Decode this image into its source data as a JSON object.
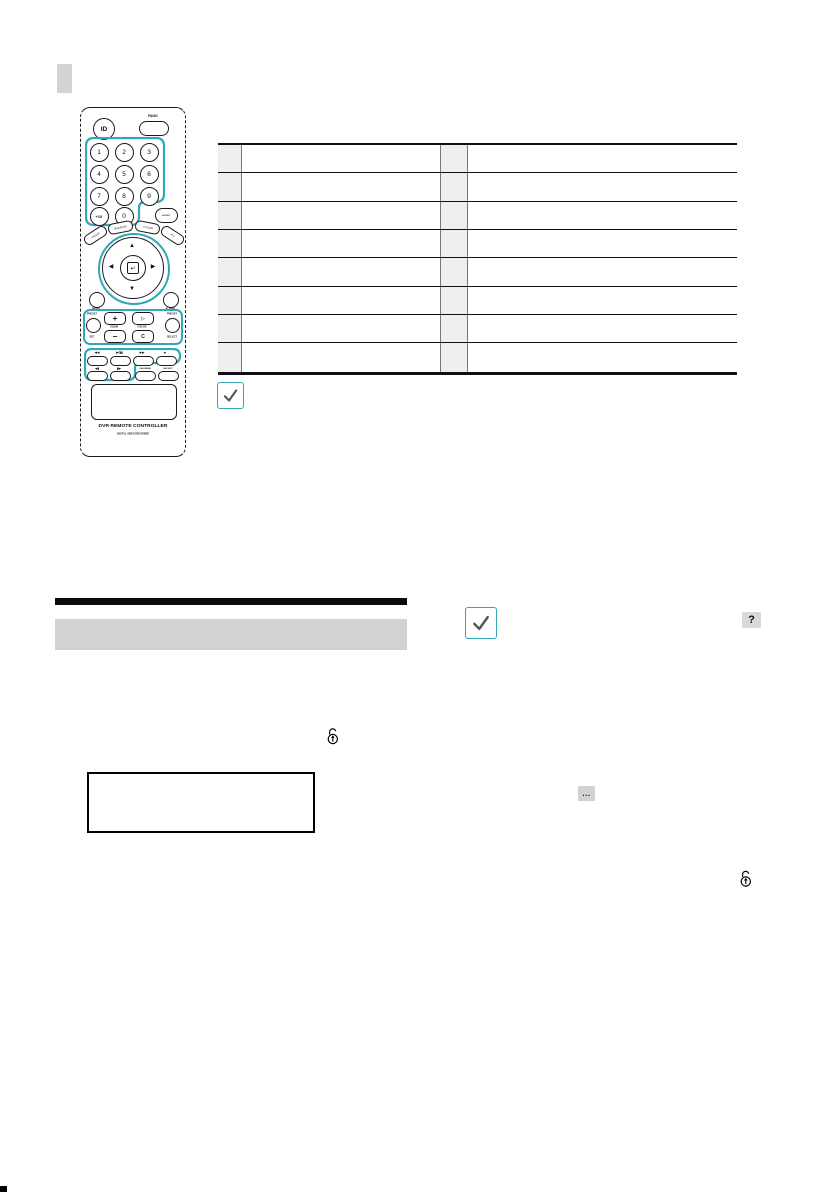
{
  "remote": {
    "id_button": "ID",
    "panic_label": "PANIC",
    "digits": [
      "1",
      "2",
      "3",
      "4",
      "5",
      "6",
      "7",
      "8",
      "9"
    ],
    "plus_ten": "+10",
    "zero": "0",
    "layout_label": "LAYOUT",
    "arc_buttons": [
      "FREEZE",
      "SEQUENCE",
      "D.ZOOM",
      "PTZ"
    ],
    "nav": {
      "up": "▲",
      "down": "▼",
      "left": "◀",
      "right": "▶",
      "enter": "↵"
    },
    "menu_label": "MENU",
    "alarm_label": "ALARM",
    "ptz_group": {
      "preset_left": "PRESET",
      "set_label": "SET",
      "zoom_plus": "+",
      "zoom_label": "ZOOM",
      "zoom_minus": "−",
      "focus_far": "▷",
      "focus_label": "FOCUS",
      "focus_near": "C",
      "preset_right": "PRESET",
      "select_label": "SELECT"
    },
    "playback_group": {
      "rewind": "◀◀",
      "play_pause": "▶/▮▮",
      "fast_forward": "▶▶",
      "stop": "■",
      "step_back": "◀▮",
      "step_forward": "▮▶",
      "calendar_label": "CALENDAR",
      "backup_label": "BACKUP"
    },
    "brand": "DVR REMOTE CONTROLLER",
    "brand_sub": "DIGITAL VIDEO RECORDER"
  },
  "table": {
    "rows": [
      {
        "num_left": "",
        "desc_left": "",
        "num_right": "",
        "desc_right": ""
      },
      {
        "num_left": "",
        "desc_left": "",
        "num_right": "",
        "desc_right": ""
      },
      {
        "num_left": "",
        "desc_left": "",
        "num_right": "",
        "desc_right": ""
      },
      {
        "num_left": "",
        "desc_left": "",
        "num_right": "",
        "desc_right": ""
      },
      {
        "num_left": "",
        "desc_left": "",
        "num_right": "",
        "desc_right": ""
      },
      {
        "num_left": "",
        "desc_left": "",
        "num_right": "",
        "desc_right": ""
      },
      {
        "num_left": "",
        "desc_left": "",
        "num_right": "",
        "desc_right": ""
      },
      {
        "num_left": "",
        "desc_left": "",
        "num_right": "",
        "desc_right": ""
      }
    ]
  },
  "icons": {
    "note_checkmark": "checkmark",
    "help": "?",
    "ellipsis": "...",
    "unlock": "unlock-arrow-up"
  },
  "colors": {
    "teal": "#31a8b6",
    "table_number_cell": "#efefef",
    "heading_bar": "#d2d2d2",
    "section_marker": "#d1d3d4",
    "help_button_bg": "#d9d9d9"
  }
}
